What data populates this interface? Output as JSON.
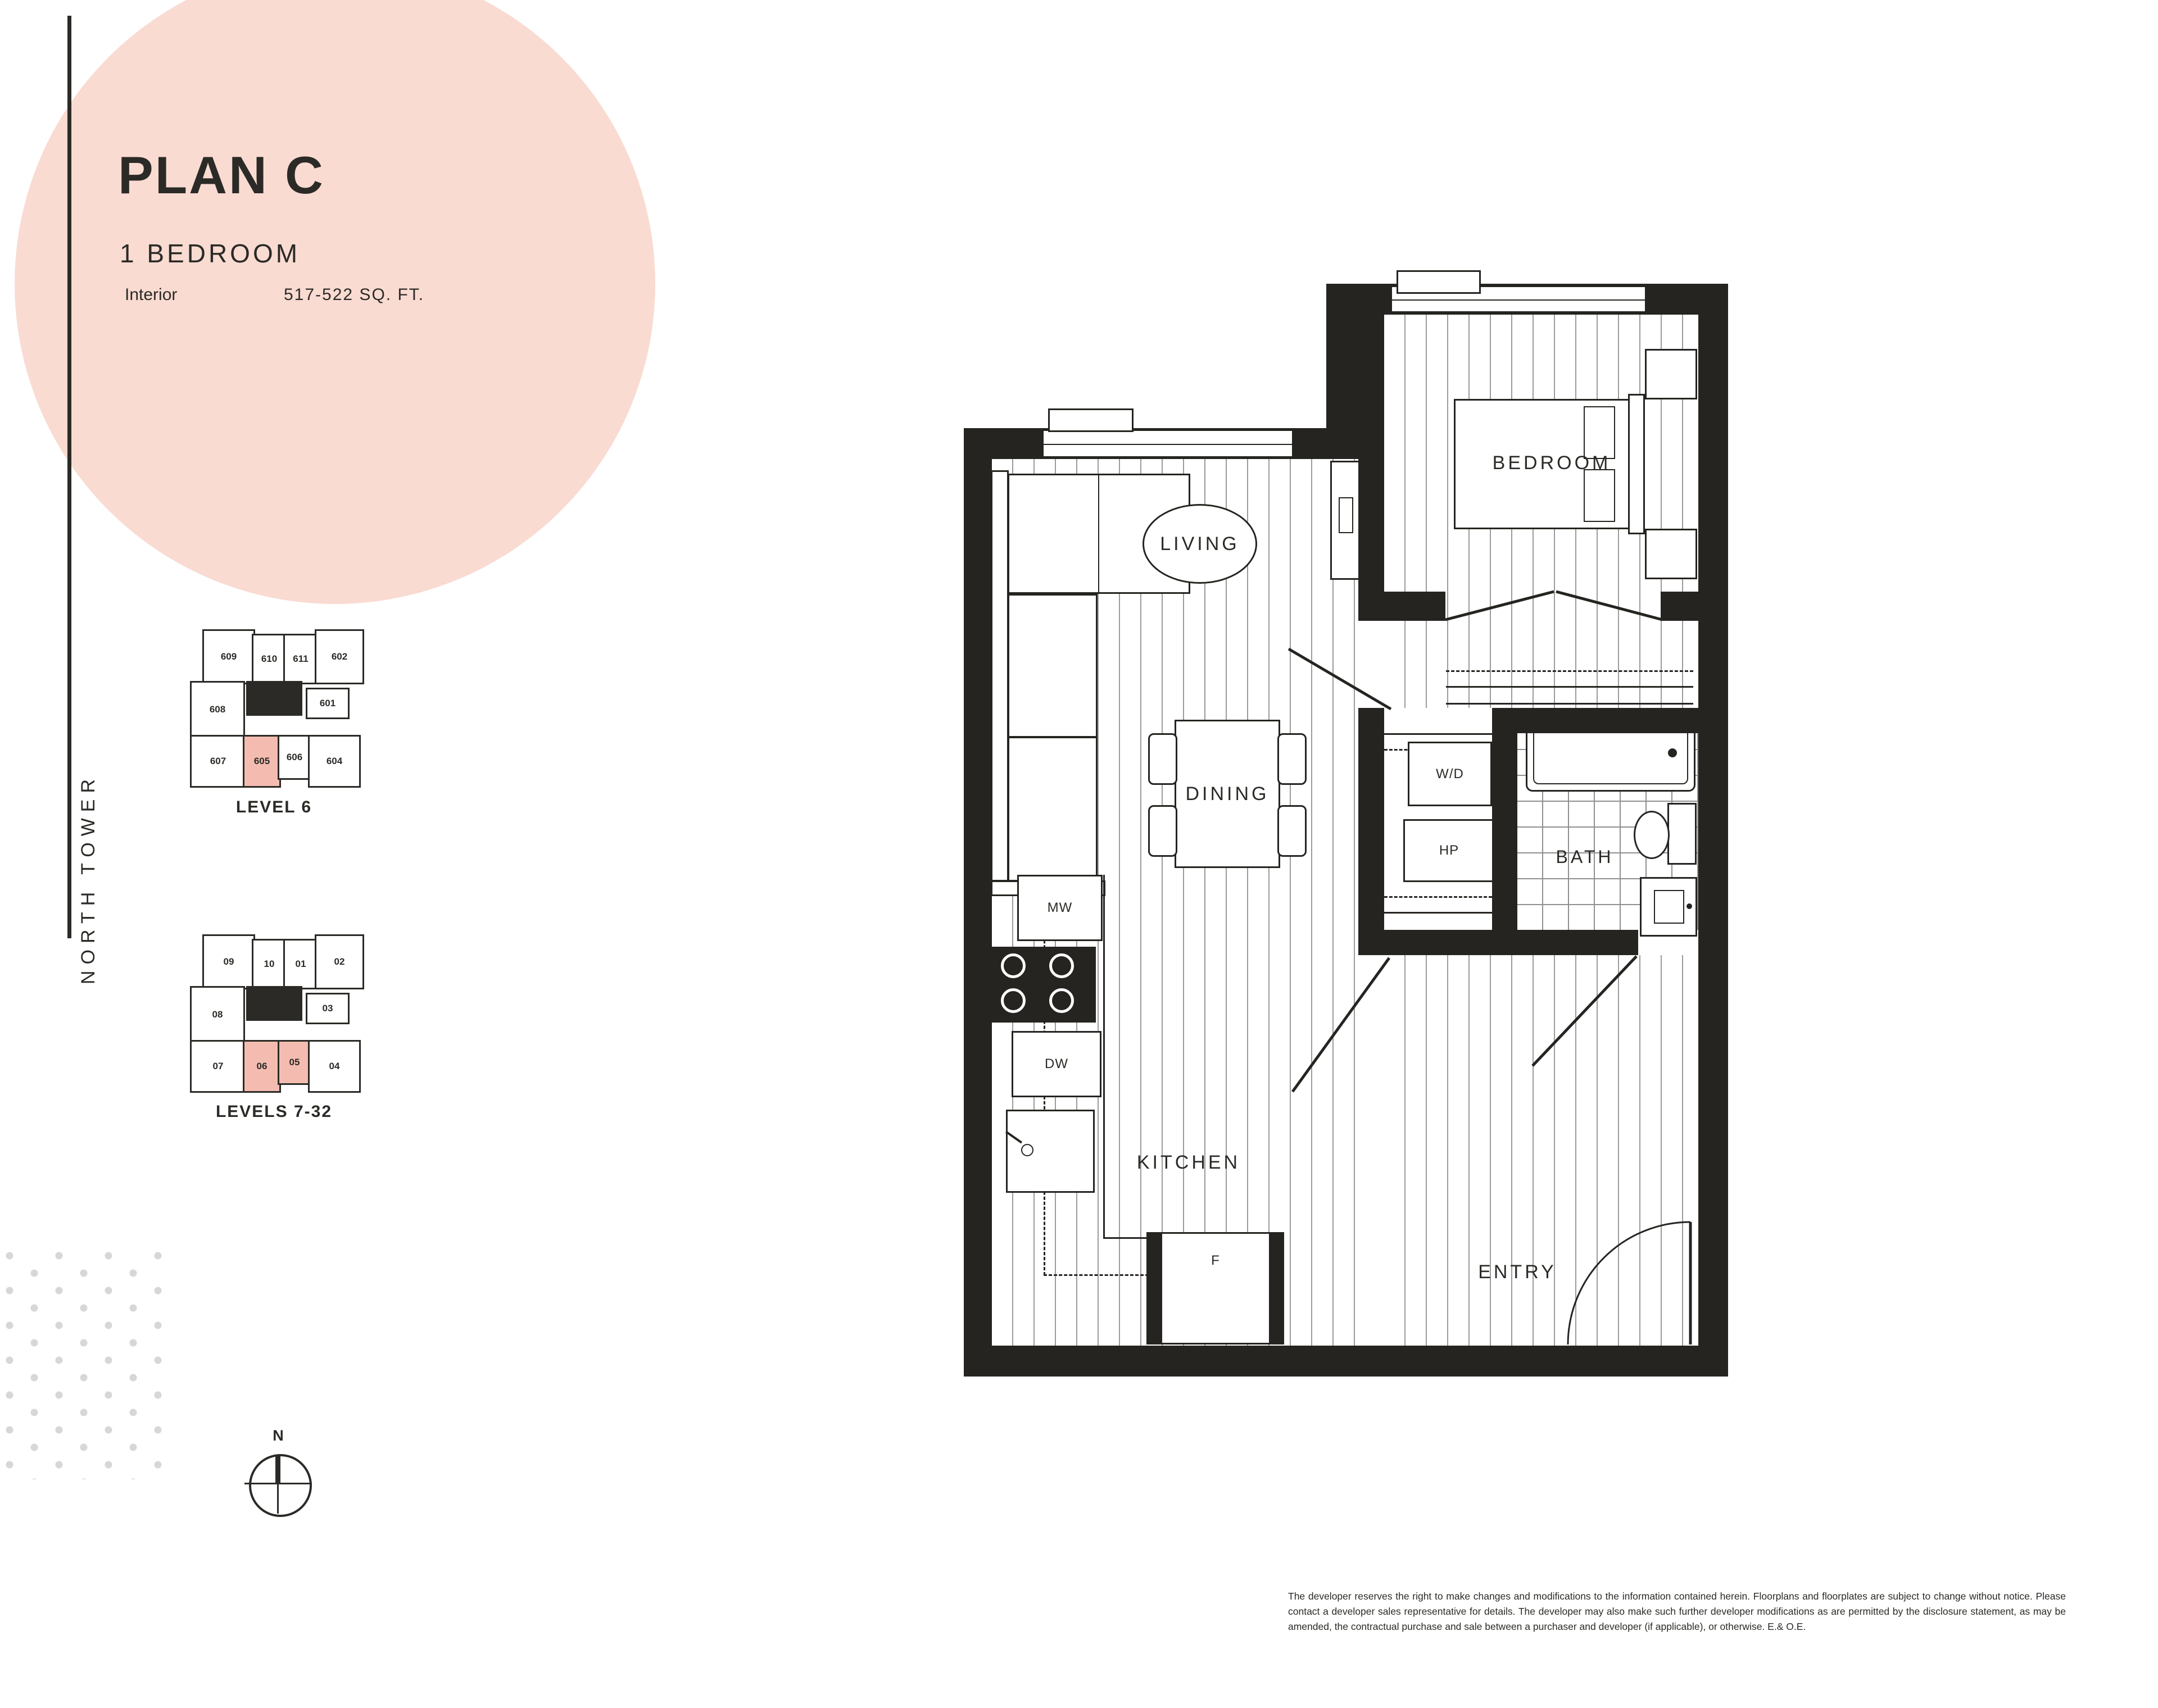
{
  "header": {
    "title": "PLAN C",
    "subtitle": "1 BEDROOM",
    "interior_label": "Interior",
    "interior_value": "517-522 SQ. FT."
  },
  "sidebar": {
    "tower_label": "NORTH TOWER"
  },
  "keyplans": {
    "level6": {
      "caption": "LEVEL 6",
      "highlighted_units": [
        "605"
      ],
      "units": {
        "u1": "609",
        "u2": "610",
        "u3": "611",
        "u4": "602",
        "u5": "608",
        "u6": "601",
        "u7": "607",
        "u8": "605",
        "u9": "606",
        "u10": "604"
      }
    },
    "levels7to32": {
      "caption": "LEVELS 7-32",
      "highlighted_units": [
        "06",
        "05"
      ],
      "units": {
        "u1": "09",
        "u2": "10",
        "u3": "01",
        "u4": "02",
        "u5": "08",
        "u6": "03",
        "u7": "07",
        "u8": "06",
        "u9": "05",
        "u10": "04"
      }
    }
  },
  "compass": {
    "north_label": "N"
  },
  "floorplan": {
    "rooms": {
      "living": "LIVING",
      "dining": "DINING",
      "kitchen": "KITCHEN",
      "bedroom": "BEDROOM",
      "bath": "BATH",
      "entry": "ENTRY"
    },
    "appliances": {
      "microwave": "MW",
      "dishwasher": "DW",
      "washer_dryer": "W/D",
      "heat_pump": "HP",
      "fridge": "F"
    }
  },
  "footer": {
    "disclaimer": "The developer reserves the right to make changes and modifications to the information contained herein. Floorplans and floorplates are subject to change without notice. Please contact a developer sales representative for details. The developer may also make such further developer modifications as are permitted by the disclosure statement, as may be amended, the contractual purchase and sale between a purchaser and developer (if applicable), or otherwise. E.& O.E."
  },
  "colors": {
    "accent_pink": "#F9DBD2",
    "highlight_pink": "#F4BCB0",
    "ink": "#2B2A26"
  }
}
